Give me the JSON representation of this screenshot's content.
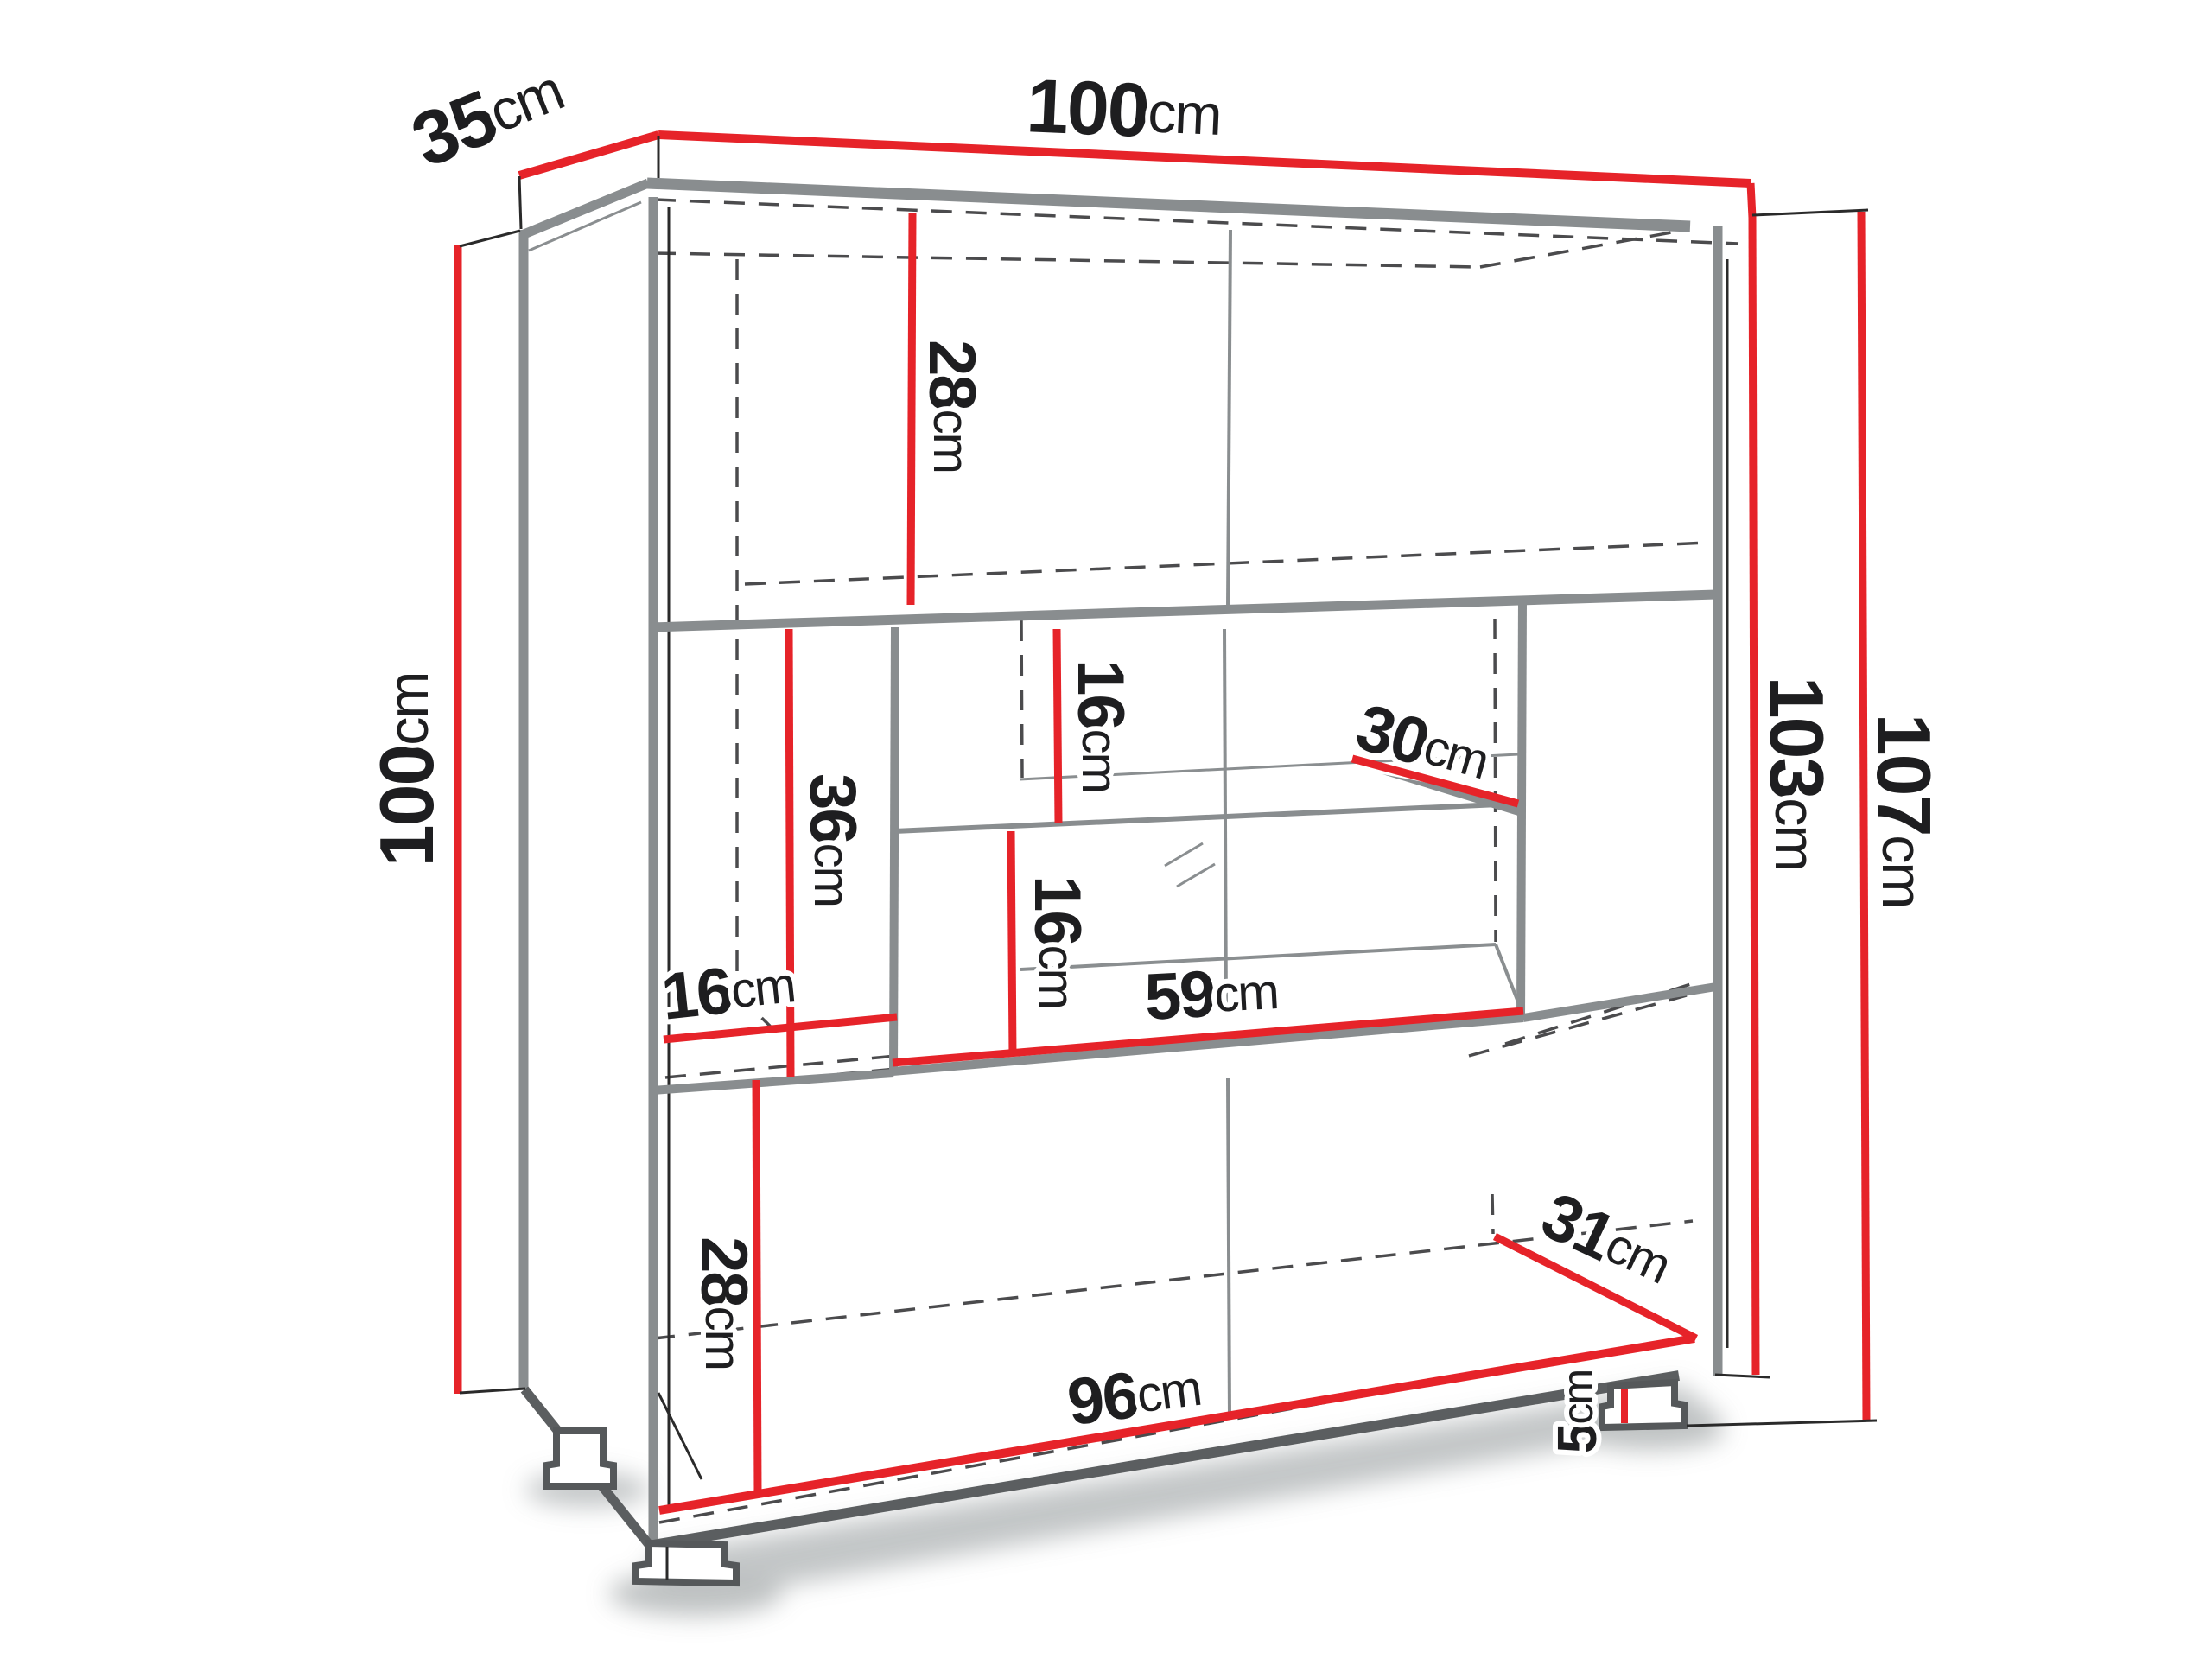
{
  "diagram": {
    "type": "furniture-dimension-diagram",
    "subject": "display cabinet with glass shelf, shown in oblique projection",
    "unit": "cm",
    "colors": {
      "dimension_line": "#e62329",
      "structure_edge": "#898d8f",
      "hidden_edge_dash": "#4b4b4d",
      "label_text": "#1e1e20",
      "background": "#ffffff"
    },
    "labels": {
      "depth_top": {
        "value": "35",
        "unit": "cm"
      },
      "width_top": {
        "value": "100",
        "unit": "cm"
      },
      "height_left": {
        "value": "100",
        "unit": "cm"
      },
      "body_height_right": {
        "value": "103",
        "unit": "cm"
      },
      "total_height_right": {
        "value": "107",
        "unit": "cm"
      },
      "top_section_height": {
        "value": "28",
        "unit": "cm"
      },
      "display_upper_height": {
        "value": "16",
        "unit": "cm"
      },
      "glass_shelf_depth": {
        "value": "30",
        "unit": "cm"
      },
      "left_compartment_height": {
        "value": "36",
        "unit": "cm"
      },
      "display_lower_height": {
        "value": "16",
        "unit": "cm"
      },
      "left_compartment_width": {
        "value": "16",
        "unit": "cm"
      },
      "display_width": {
        "value": "59",
        "unit": "cm"
      },
      "bottom_section_height": {
        "value": "28",
        "unit": "cm"
      },
      "bottom_depth": {
        "value": "31",
        "unit": "cm"
      },
      "interior_width": {
        "value": "96",
        "unit": "cm"
      },
      "foot_height": {
        "value": "5",
        "unit": "cm"
      }
    }
  }
}
